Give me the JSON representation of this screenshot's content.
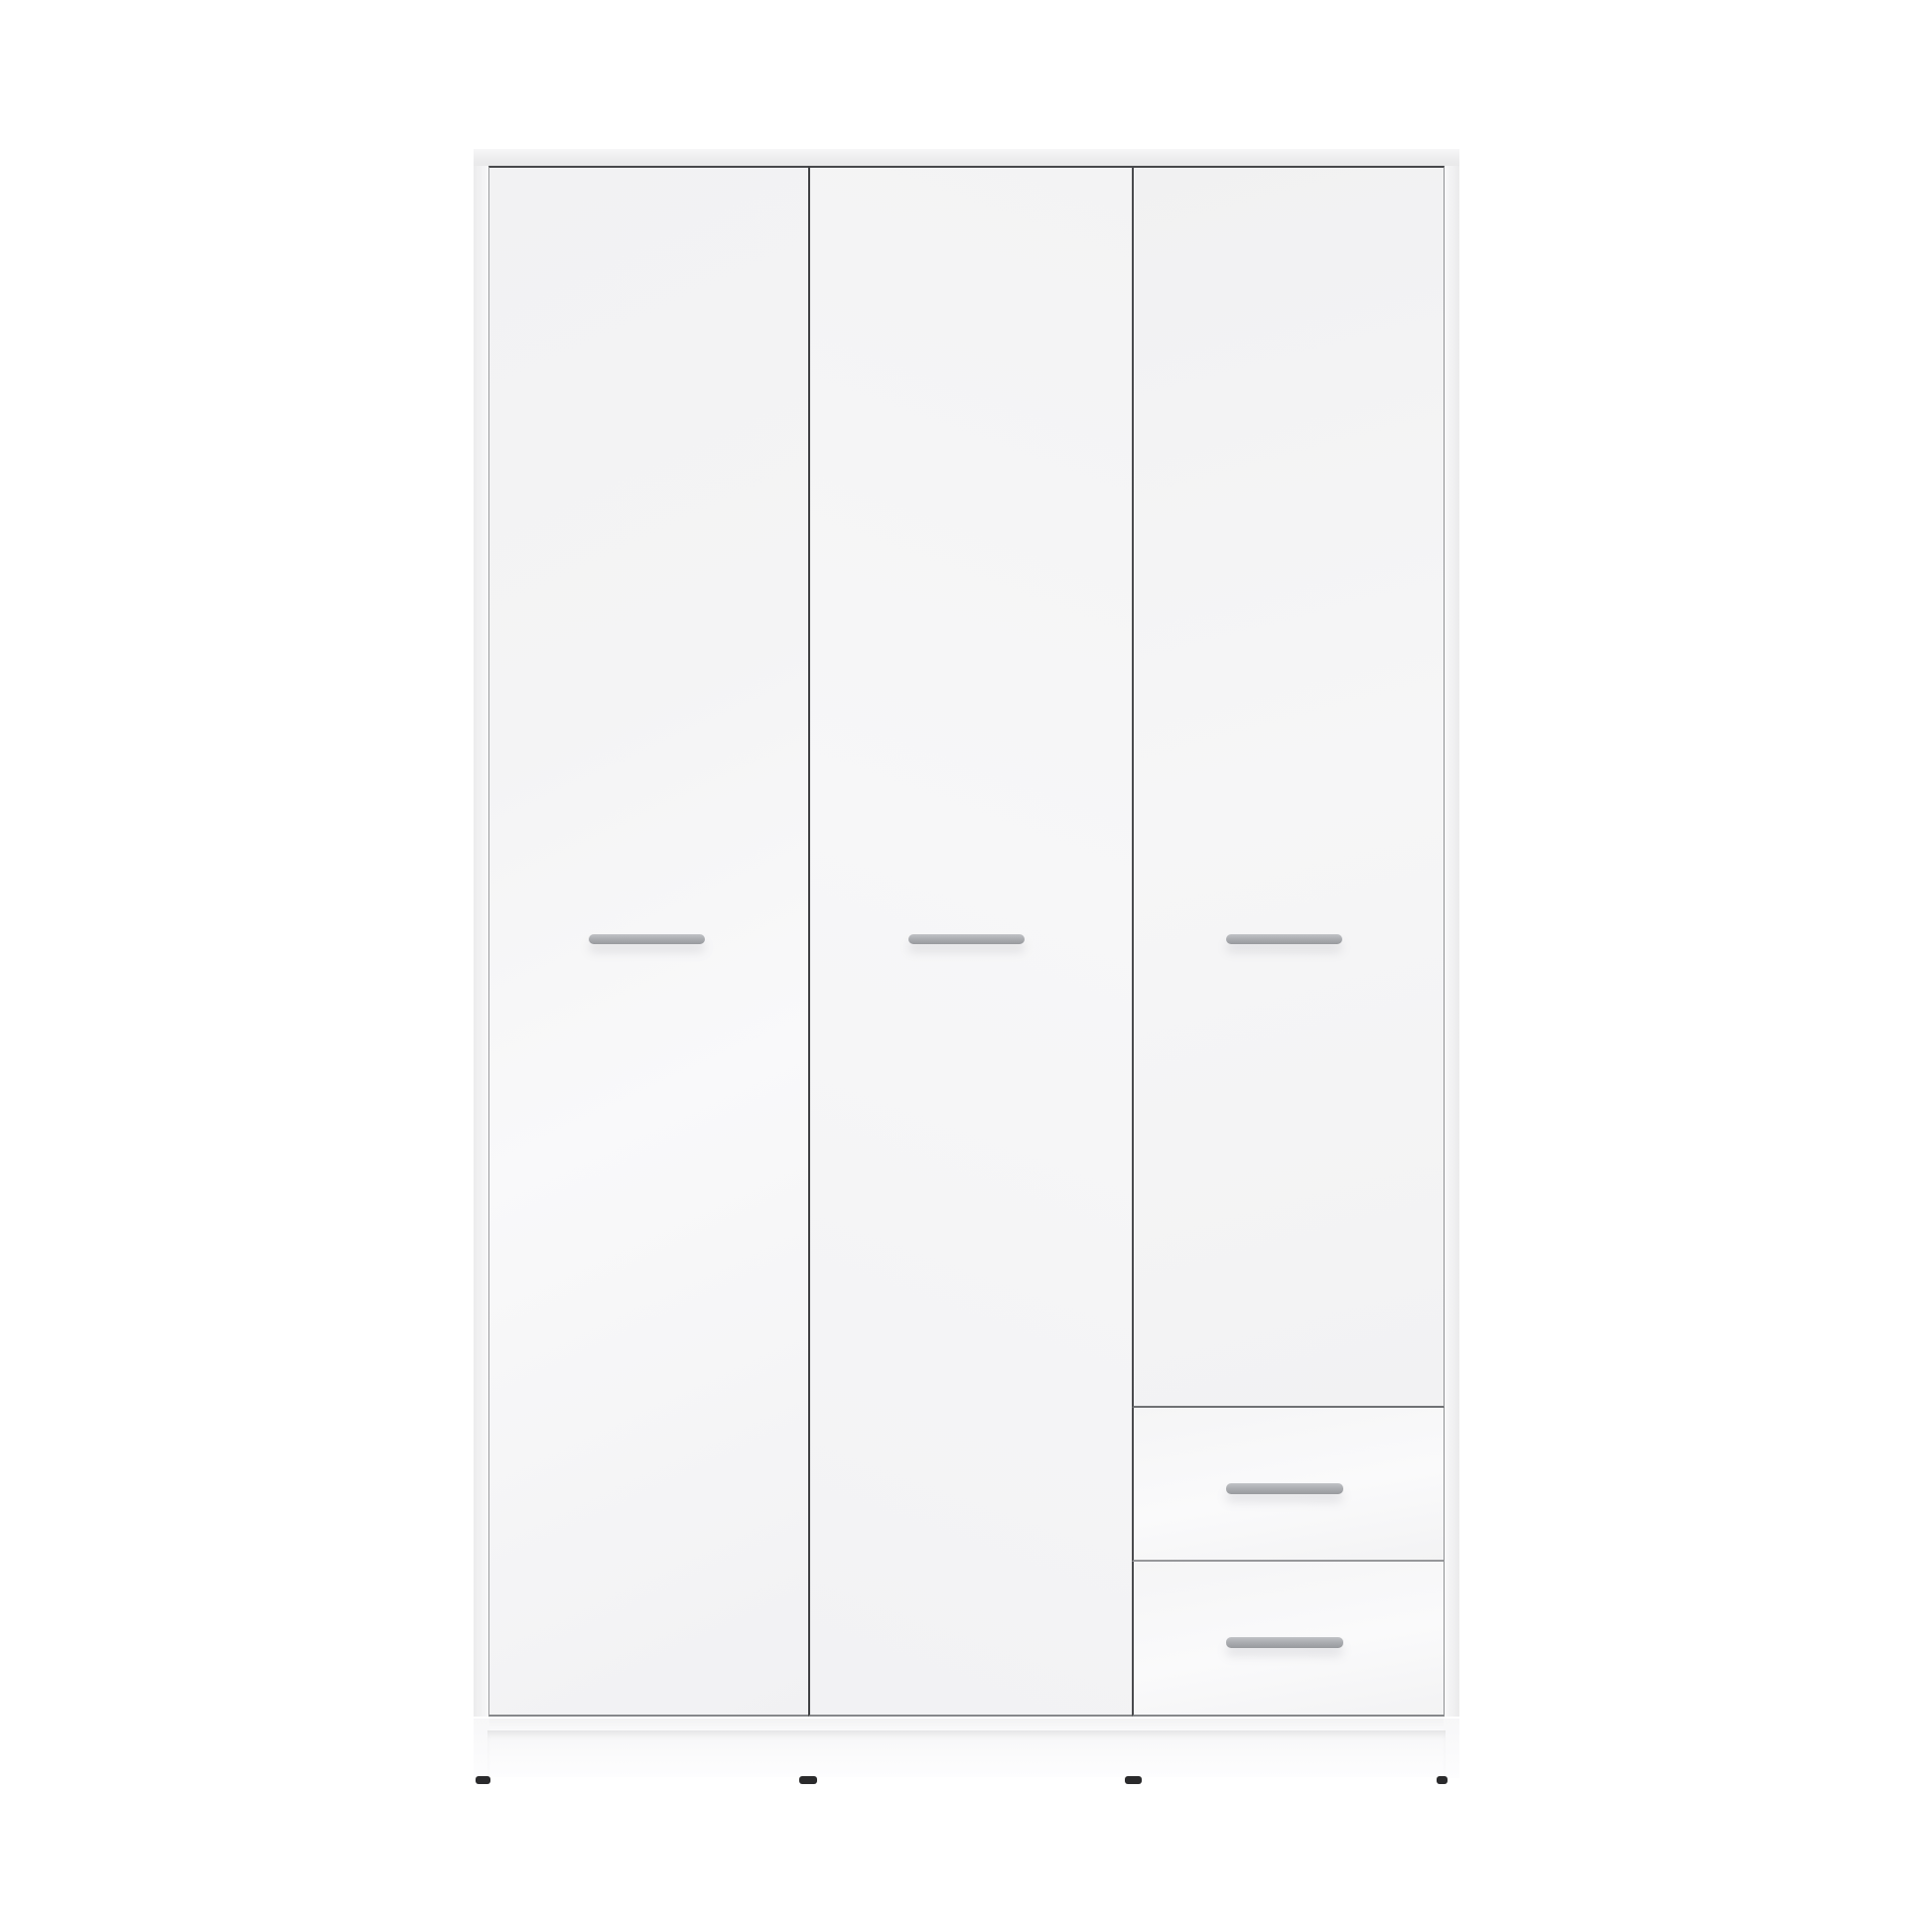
{
  "page": {
    "background_color": "#ffffff",
    "description": "Product photograph of a tall white wardrobe with three hinged doors, two drawers in the lower right column, horizontal gray bar handles, a recessed plinth and four small dark feet"
  },
  "colors": {
    "background": "#ffffff",
    "cabinet-face": "#f4f4f5",
    "cabinet-face-light": "#f9f9fa",
    "top-panel": "#ededee",
    "gap-dark": "#47484b",
    "gap-soft": "#8f9194",
    "edge-soft": "#9b9c9f",
    "handle": "#a8aaae",
    "handle-light": "#c0c2c6",
    "plinth": "#fbfbfc",
    "foot": "#2a2a2c"
  },
  "wardrobe": {
    "style": "flat-front matte white",
    "door_count": 3,
    "drawer_count": 2,
    "handle_count": 5,
    "feet_count": 4,
    "doors": [
      {
        "name": "left-door",
        "handle_type": "horizontal-bar"
      },
      {
        "name": "middle-door",
        "handle_type": "horizontal-bar"
      },
      {
        "name": "right-door",
        "handle_type": "horizontal-bar"
      }
    ],
    "drawers": [
      {
        "name": "upper-drawer",
        "handle_type": "horizontal-bar"
      },
      {
        "name": "lower-drawer",
        "handle_type": "horizontal-bar"
      }
    ]
  }
}
